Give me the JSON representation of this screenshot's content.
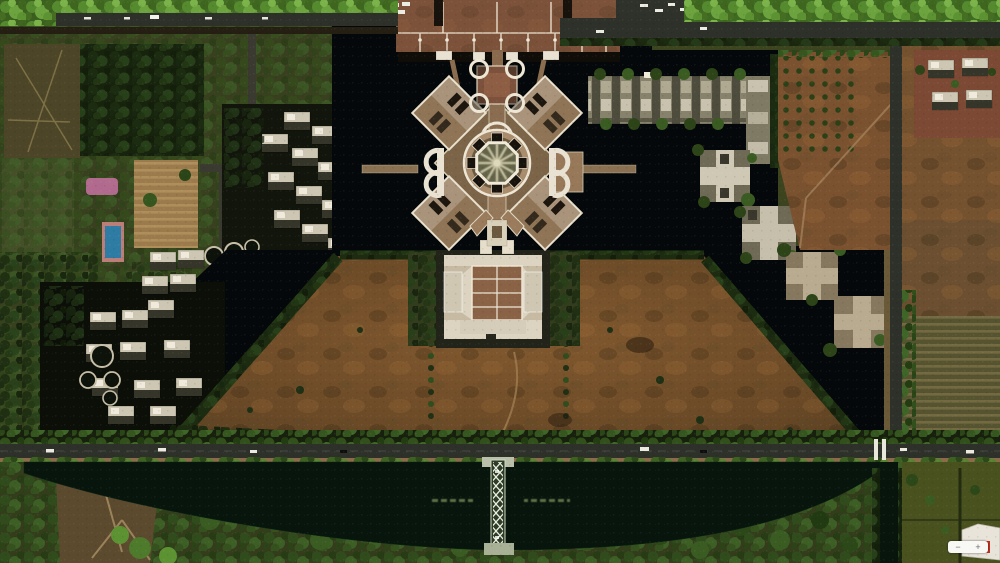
{
  "palette": {
    "water": "#05080a",
    "lake-green": "#07150d",
    "road": "#2e302a",
    "verge": "#8a6a48",
    "field": "#7b5230",
    "plaza-brick": "#7d523a",
    "building-tan": "#a98c6c",
    "building-white": "#efe7d6",
    "lawn": "#6e4c28",
    "trees-bright": "#5f9334",
    "trees-dark": "#1f2d15",
    "pool-blue": "#2e7ca3",
    "pool-deck": "#bb7e78",
    "pink-garden": "#bf6f9a",
    "marker-red": "#c23322"
  },
  "overlay": {
    "zoom_control": {
      "zoom_out_label": "−",
      "zoom_in_label": "+"
    }
  }
}
